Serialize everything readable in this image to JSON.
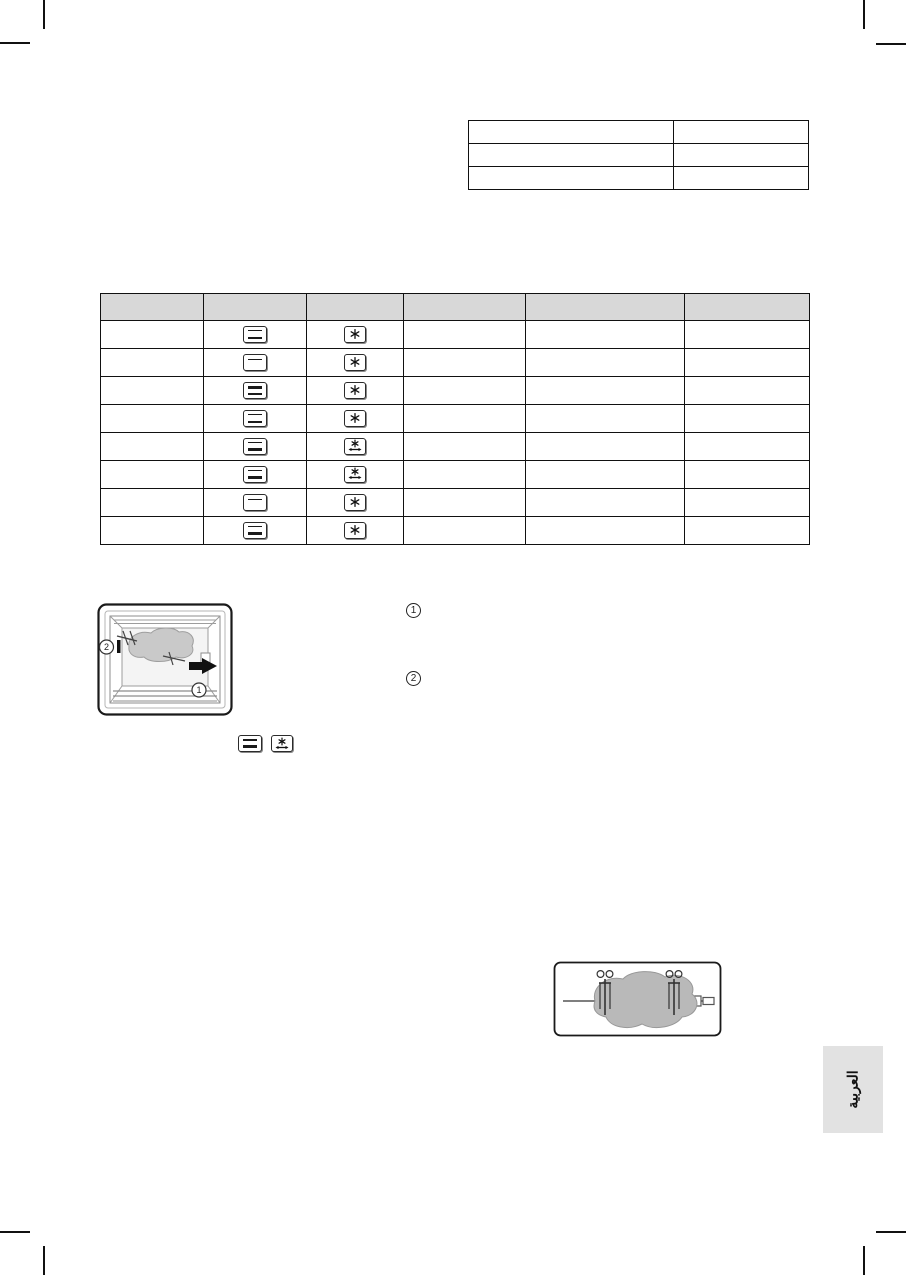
{
  "page": {
    "background": "#ffffff",
    "type": "scanned-manual-page"
  },
  "spec_table": {
    "columns": 2,
    "rows": 3,
    "cells": [
      [
        "",
        ""
      ],
      [
        "",
        ""
      ],
      [
        "",
        ""
      ]
    ]
  },
  "mode_table": {
    "header_bg": "#d8d8d8",
    "column_headers": [
      "",
      "",
      "",
      "",
      "",
      ""
    ],
    "rows": [
      {
        "heater_icon": "heat-top-bottom",
        "fan_icon": "fan"
      },
      {
        "heater_icon": "heat-top",
        "fan_icon": "fan"
      },
      {
        "heater_icon": "heat-thick-top-bottom",
        "fan_icon": "fan"
      },
      {
        "heater_icon": "heat-top-bottom",
        "fan_icon": "fan"
      },
      {
        "heater_icon": "heat-top-bottom-thick",
        "fan_icon": "fan-rotisserie"
      },
      {
        "heater_icon": "heat-top-bottom-thick",
        "fan_icon": "fan-rotisserie"
      },
      {
        "heater_icon": "heat-top",
        "fan_icon": "fan"
      },
      {
        "heater_icon": "heat-top-bottom-thick",
        "fan_icon": "fan"
      }
    ]
  },
  "oven_figure": {
    "marker_1": "1",
    "marker_2": "2",
    "meat_color": "#c9c9c9"
  },
  "callouts": {
    "item_1": "1",
    "item_2": "2"
  },
  "inline_icons": {
    "heater_icon": "heat-top-bottom-thick",
    "fan_icon": "fan-rotisserie"
  },
  "rotisserie_figure": {
    "meat_color": "#b9b9b9"
  },
  "language_tab": {
    "label": "العربية",
    "bg": "#e2e2e2"
  },
  "colors": {
    "table_border": "#111111",
    "header_gray": "#d8d8d8",
    "crop_mark": "#111111"
  }
}
